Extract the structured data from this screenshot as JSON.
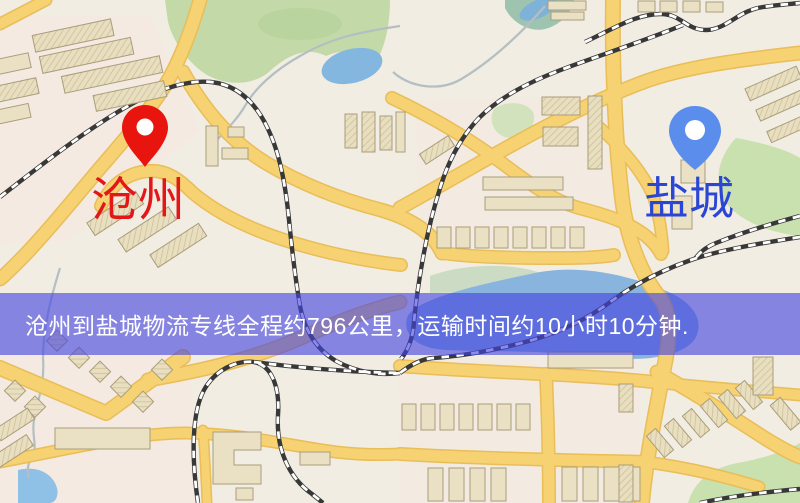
{
  "banner": {
    "text": "沧州到盐城物流专线全程约796公里，运输时间约10小时10分钟.",
    "background_color": "rgba(68,68,224,0.62)",
    "text_color": "#ffffff"
  },
  "markers": {
    "origin": {
      "label": "沧州",
      "pin_color": "#e8140e",
      "label_color": "#e31717"
    },
    "destination": {
      "label": "盐城",
      "pin_color": "#5b8ded",
      "label_color": "#2b46d4"
    }
  },
  "map_colors": {
    "base": "#f2ede3",
    "road_fill": "#f6d272",
    "road_casing": "#e9bd58",
    "park_green": "#c3d9a8",
    "water_blue": "#88b4de",
    "railway_dark": "#383838",
    "building_beige": "#eae1c4"
  }
}
